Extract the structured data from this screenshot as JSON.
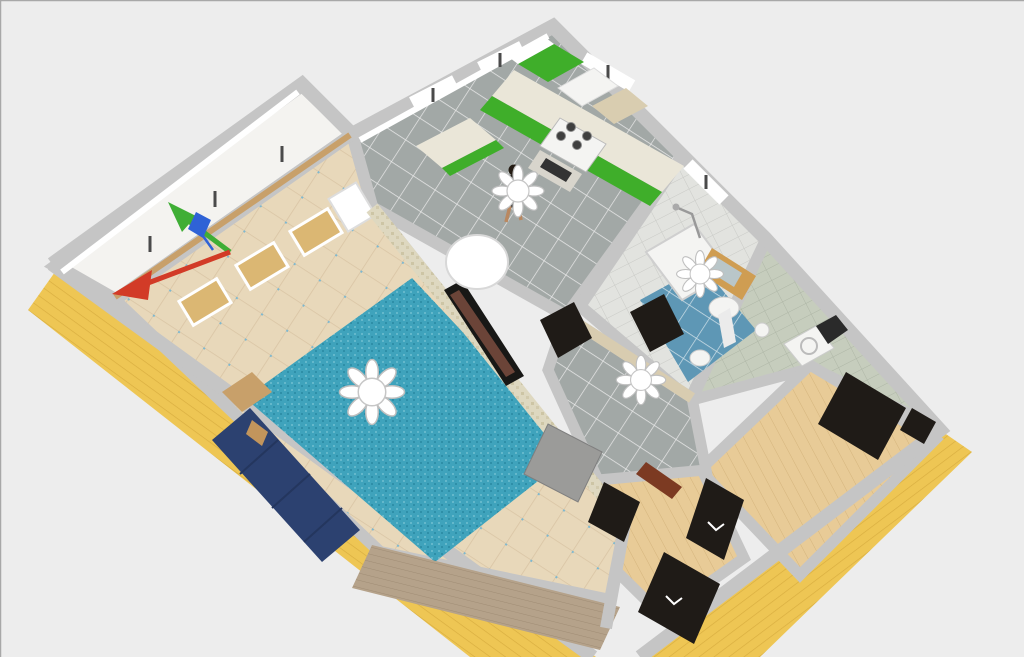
{
  "view": {
    "type": "3d-floor-plan-render",
    "tool": "home-design-3d-view",
    "rooms": [
      {
        "name": "balcony"
      },
      {
        "name": "living-room"
      },
      {
        "name": "kitchen"
      },
      {
        "name": "bathroom"
      },
      {
        "name": "hallway"
      },
      {
        "name": "laundry-nook"
      },
      {
        "name": "bedroom"
      },
      {
        "name": "entry-hall"
      }
    ],
    "furniture": [
      "sofa",
      "cat",
      "rug",
      "tv",
      "side-table",
      "sideboard",
      "round-table",
      "kitchen-cabinets",
      "stove",
      "oven",
      "fridge",
      "tall-cabinet",
      "bathtub",
      "pedestal-sink",
      "mirror-cabinet",
      "toilet",
      "waste-bin",
      "washing-machine",
      "wardrobe",
      "doors",
      "ceiling-lamps",
      "person"
    ],
    "gizmo": {
      "axes": [
        {
          "name": "axis-green",
          "color": "#3fae35"
        },
        {
          "name": "axis-red",
          "color": "#d23b27"
        },
        {
          "name": "axis-blue",
          "color": "#2f62d6"
        }
      ]
    }
  },
  "colors": {
    "background": "#ededed",
    "border": "#a8a8a8",
    "wall_top": "#c5c5c5",
    "wall_inner": "#ffffff",
    "facade_yellow": "#eec654",
    "facade_line": "#d8ad3f",
    "floor_beige": "#e8d8ba",
    "grout_beige": "#d9c4a4",
    "accent_blue_tile": "#7fb8cf",
    "carpet": "#3fa3bc",
    "carpet_dark": "#2e8fa8",
    "carpet_light": "#64b8cb",
    "sofa": "#2c4170",
    "sofa_line": "#24365e",
    "cat": "#c2955c",
    "floor_gray": "#a2a8a6",
    "grout_white": "#e8e8e8",
    "floor_blue": "#5e97b5",
    "grout_blue": "#cfe0e8",
    "bath_wall": "#e2e3df",
    "bath_wall_line": "#c9cac6",
    "laundry_wall": "#c6cdbd",
    "laundry_wall_line": "#aeb6a6",
    "wood_floor": "#e8cb97",
    "wood_line": "#d4b47c",
    "sideboard": "#b5a28a",
    "sideboard_line": "#9d8a72",
    "rail": "#c8a06a",
    "mosaic": "#ded8c0",
    "mosaic_dot": "#cdc5a5",
    "cabinet_green": "#3fae2a",
    "counter": "#eae6d8",
    "appliance": "#f4f4f2",
    "tall_cabinet": "#d9cdb0",
    "burner": "#3f3f3f",
    "oven": "#d8d5cc",
    "oven_glass": "#333333",
    "door_dark": "#1f1b17",
    "door_gray": "#9b9b99",
    "threshold": "#7c3a22",
    "mirror_wood": "#cf9d52",
    "mirror_glass": "#b9c6c9",
    "tv_frame": "#181816",
    "tv_screen": "#6b4438",
    "chandelier": "#ffffff",
    "chandelier_stroke": "#c6c6c6",
    "window_wood": "#dbb773",
    "mullion": "#4a4a4a",
    "balcony_floor": "#f4f3f0",
    "skin": "#b98860",
    "shirt": "#17110c",
    "hair": "#241c14",
    "axis_red": "#d23b27",
    "axis_green": "#3fae35",
    "axis_blue": "#2f62d6"
  }
}
